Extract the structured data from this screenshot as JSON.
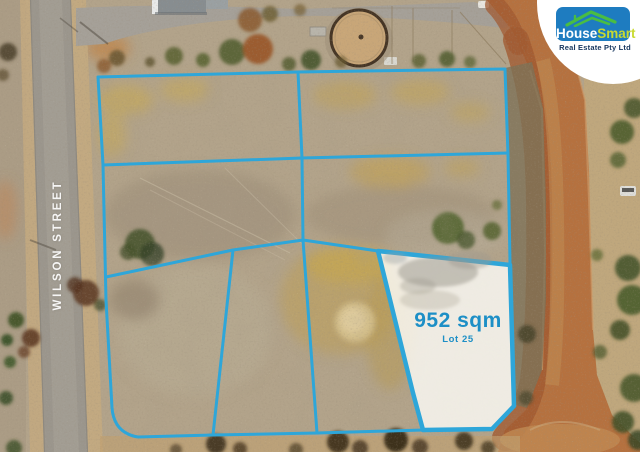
{
  "annotations": {
    "boundary_color": "#2ea6d9",
    "highlighted_lot": {
      "area_label": "952 sqm",
      "lot_label": "Lot 25",
      "label_color": "#1d8fc6",
      "fill": "#fbfaf6"
    },
    "street_label": {
      "text": "WILSON STREET",
      "color": "#ffffff"
    }
  },
  "logo": {
    "brand_first": "House",
    "brand_second": "Smart",
    "tagline": "Real Estate Pty Ltd",
    "box_color": "#1e7cc0",
    "roof_color": "#49bd43",
    "house_color": "#ffffff",
    "smart_color": "#c9da30",
    "tagline_color": "#16365e"
  }
}
